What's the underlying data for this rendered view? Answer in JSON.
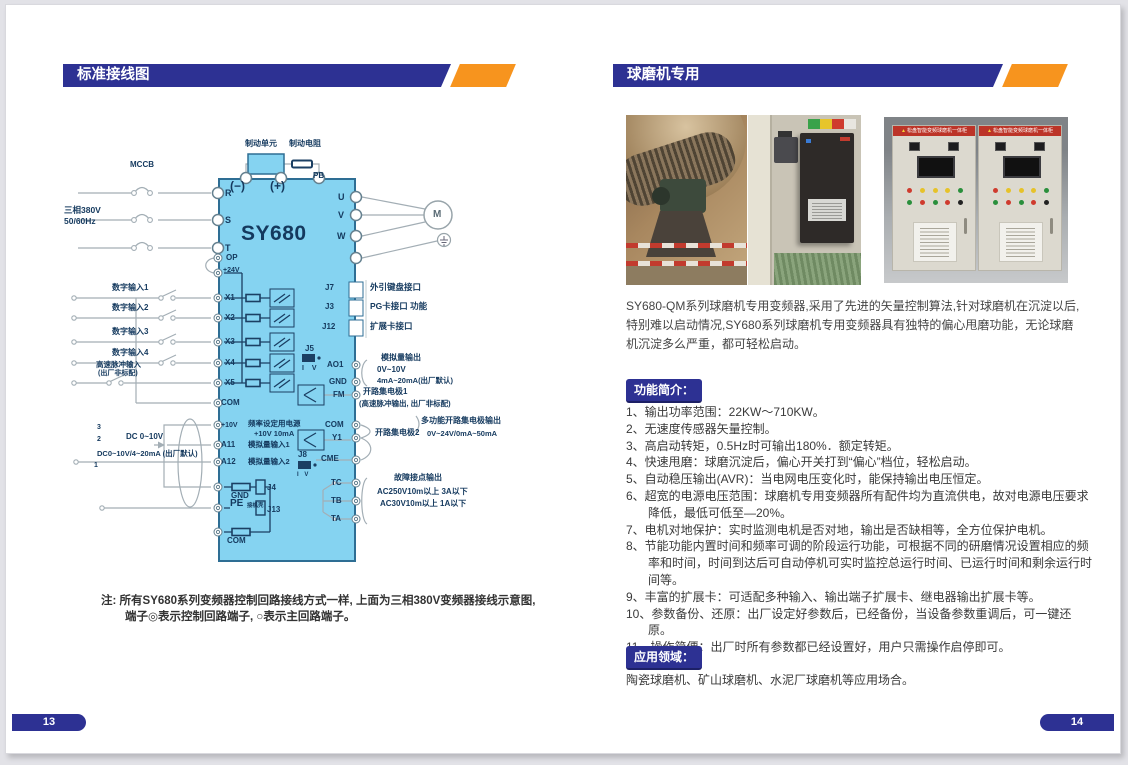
{
  "page_left": {
    "header": "标准接线图",
    "page_number": "13",
    "diagram": {
      "labels": {
        "mccb": "MCCB",
        "supply1": "三相380V",
        "supply2": "50/60Hz",
        "brake_unit": "制动单元",
        "brake_res": "制动电阻",
        "minus": "(−)",
        "plus": "(+)",
        "pb": "PB",
        "model": "SY680",
        "r": "R",
        "s": "S",
        "t": "T",
        "u": "U",
        "v": "V",
        "w": "W",
        "motor": "M",
        "op": "OP",
        "v24": "+24V",
        "x1": "X1",
        "x2": "X2",
        "x3": "X3",
        "x4": "X4",
        "x5": "X5",
        "di1": "数字输入1",
        "di2": "数字输入2",
        "di3": "数字输入3",
        "di4": "数字输入4",
        "hs1": "高速脉冲输入",
        "hs2": "(出厂非标配)",
        "com": "COM",
        "v10": "+10V",
        "fs1": "频率设定用电源",
        "fs2": "+10V 10mA",
        "ai1": "A11",
        "ai1_lab": "模拟量输入1",
        "ai2": "A12",
        "ai2_lab": "模拟量输入2",
        "dc1": "DC 0~10V",
        "dc2": "DC0~10V/4~20mA (出厂默认)",
        "p3": "3",
        "p2": "2",
        "p1": "1",
        "gnd": "GND",
        "j4": "J4",
        "pe": "PE",
        "pe_sub": "接机壳",
        "j13": "J13",
        "com_b": "COM",
        "j7": "J7",
        "j3": "J3",
        "j12": "J12",
        "j7_lab": "外引键盘接口",
        "j3_lab": "PG卡接口 功能",
        "j12_lab": "扩展卡接口",
        "j5": "J5",
        "iv": "I V",
        "ao1": "AO1",
        "gnd2": "GND",
        "ao_1": "模拟量输出",
        "ao_2": "0V~10V",
        "ao_3": "4mA~20mA(出厂默认)",
        "fm": "FM",
        "oc1a": "开路集电极1",
        "oc1b": "(高速脉冲输出, 出厂非标配)",
        "com2": "COM",
        "y1": "Y1",
        "oc2": "开路集电极2",
        "moc1": "多功能开路集电极输出",
        "moc2": "0V~24V/0mA~50mA",
        "j8": "J8",
        "cme": "CME",
        "tc": "TC",
        "tb": "TB",
        "ta": "TA",
        "flt1": "故障接点输出",
        "flt2": "AC250V10m以上 3A以下",
        "flt3": "AC30V10m以上 1A以下"
      }
    },
    "note_line1": "注: 所有SY680系列变频器控制回路接线方式一样, 上面为三相380V变频器接线示意图,",
    "note_line2": "端子◎表示控制回路端子, ○表示主回路端子。"
  },
  "page_right": {
    "header": "球磨机专用",
    "page_number": "14",
    "photos": {
      "cabinet_banner": "松盘智能变频球磨机一体柜"
    },
    "intro": "SY680-QM系列球磨机专用变频器,采用了先进的矢量控制算法,针对球磨机在沉淀以后,特别难以启动情况,SY680系列球磨机专用变频器具有独特的偏心甩磨功能，无论球磨机沉淀多么严重，都可轻松启动。",
    "features_title": "功能简介：",
    "features": [
      "1、输出功率范围：22KW～710KW。",
      "2、无速度传感器矢量控制。",
      "3、高启动转矩，0.5Hz时可输出180%．额定转矩。",
      "4、快速甩磨：球磨沉淀后，偏心开关打到“偏心”档位，轻松启动。",
      "5、自动稳压输出(AVR)：当电网电压变化时，能保持输出电压恒定。",
      "6、超宽的电源电压范围：球磨机专用变频器所有配件均为直流供电，故对电源电压要求降低，最低可低至—20%。",
      "7、电机对地保护：实时监测电机是否对地，输出是否缺相等，全方位保护电机。",
      "8、节能功能内置时间和频率可调的阶段运行功能，可根据不同的研磨情况设置相应的频率和时间，时间到达后可自动停机可实时监控总运行时间、已运行时间和剩余运行时间等。",
      "9、丰富的扩展卡：可适配多种输入、输出端子扩展卡、继电器输出扩展卡等。",
      "10、参数备份、还原：出厂设定好参数后，已经备份，当设备参数重调后，可一键还原。",
      "11、操作简便：出厂时所有参数都已经设置好，用户只需操作启停即可。"
    ],
    "applications_title": "应用领域：",
    "applications": "陶瓷球磨机、矿山球磨机、水泥厂球磨机等应用场合。"
  }
}
